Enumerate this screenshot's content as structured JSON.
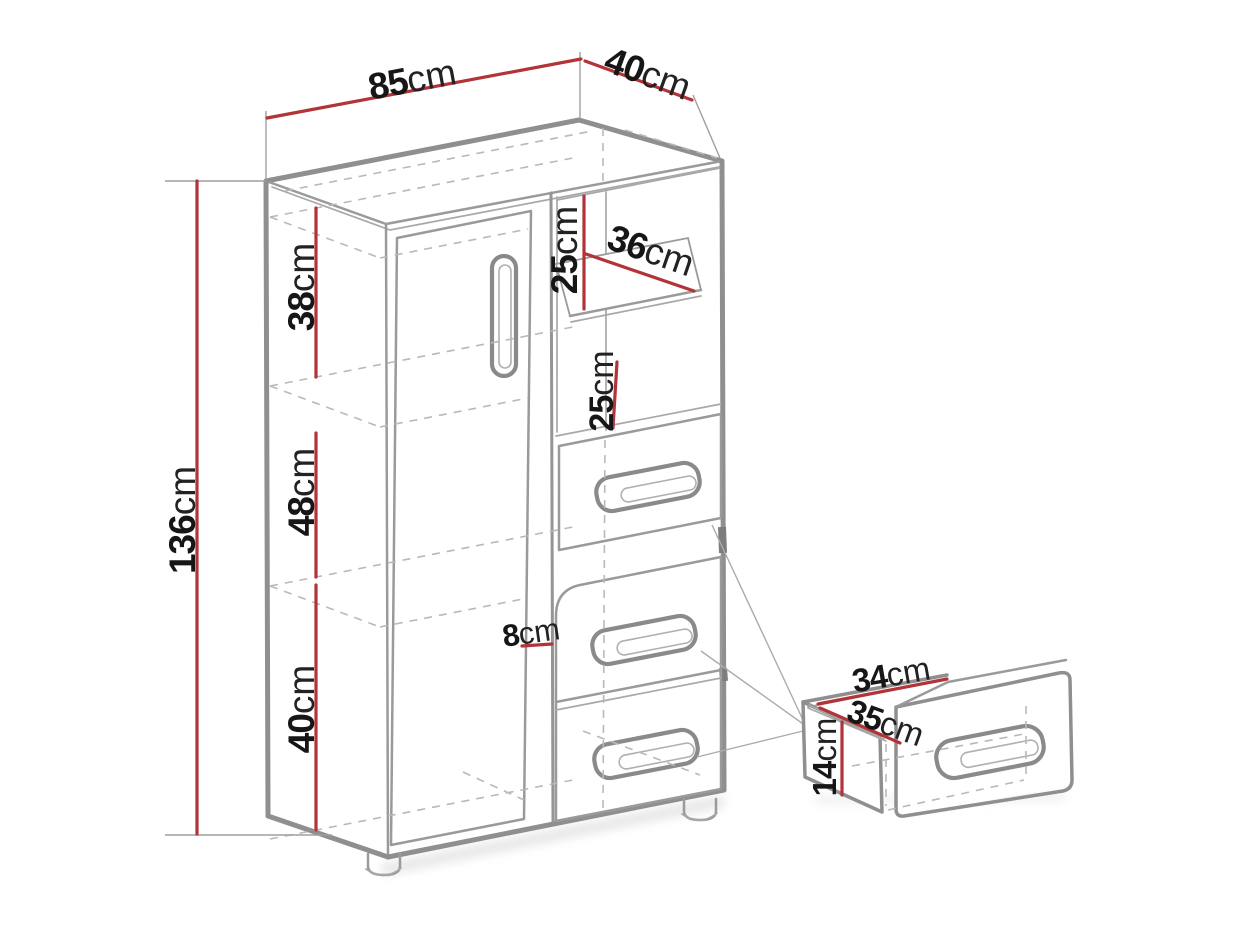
{
  "dims": {
    "width": {
      "value": "85",
      "unit": "cm"
    },
    "depth": {
      "value": "40",
      "unit": "cm"
    },
    "height": {
      "value": "136",
      "unit": "cm"
    },
    "upper_section": {
      "value": "38",
      "unit": "cm"
    },
    "middle_section": {
      "value": "48",
      "unit": "cm"
    },
    "lower_section": {
      "value": "40",
      "unit": "cm"
    },
    "upper_opening": {
      "value": "25",
      "unit": "cm"
    },
    "shelf_depth": {
      "value": "36",
      "unit": "cm"
    },
    "lower_opening": {
      "value": "25",
      "unit": "cm"
    },
    "front_offset": {
      "value": "8",
      "unit": "cm"
    },
    "drawer_width": {
      "value": "34",
      "unit": "cm"
    },
    "drawer_depth": {
      "value": "35",
      "unit": "cm"
    },
    "drawer_height": {
      "value": "14",
      "unit": "cm"
    }
  },
  "colors": {
    "dimension_line": "#b23438",
    "outline": "#8f8f8f",
    "hidden_line": "#b9b9b9",
    "text": "#161616",
    "background": "#ffffff"
  }
}
